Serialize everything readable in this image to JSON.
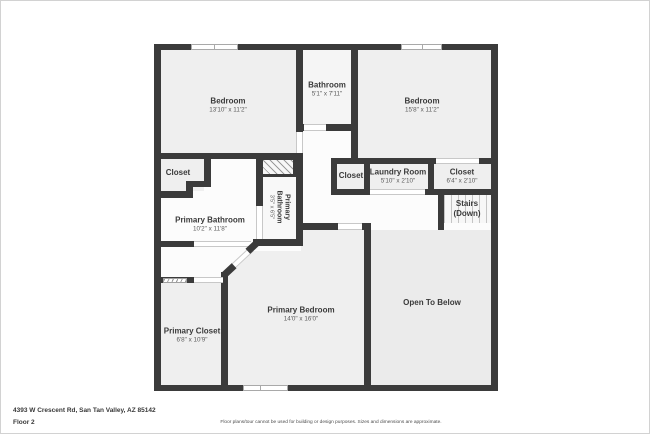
{
  "meta": {
    "address": "4393 W Crescent Rd, San Tan Valley, AZ 85142",
    "floor_label": "Floor 2",
    "disclaimer": "Floor plans/tour cannot be used for building or design purposes. Sizes and dimensions are approximate."
  },
  "plan": {
    "colors": {
      "wall": "#3b3b3b",
      "room_fill": "#efefef",
      "hall_fill": "#fcfcfc",
      "open_to_below_fill": "#ebebeb",
      "stairs_fill": "#f7f7f7",
      "door_line": "#c8c8c8",
      "window_border": "#a9a9a9"
    },
    "rooms": [
      {
        "id": "bedroom-1",
        "name": "Bedroom",
        "dims": "13'10\" x 11'2\""
      },
      {
        "id": "bathroom",
        "name": "Bathroom",
        "dims": "5'1\" x 7'11\""
      },
      {
        "id": "bedroom-2",
        "name": "Bedroom",
        "dims": "15'8\" x 11'2\""
      },
      {
        "id": "closet-left",
        "name": "Closet",
        "dims": ""
      },
      {
        "id": "closet-middle",
        "name": "Closet",
        "dims": ""
      },
      {
        "id": "laundry-room",
        "name": "Laundry Room",
        "dims": "5'10\" x 2'10\""
      },
      {
        "id": "closet-right",
        "name": "Closet",
        "dims": "6'4\" x 2'10\""
      },
      {
        "id": "stairs",
        "name": "Stairs",
        "dims": "(Down)"
      },
      {
        "id": "primary-bathroom",
        "name": "Primary Bathroom",
        "dims": "10'2\" x 11'8\""
      },
      {
        "id": "primary-bathroom-small",
        "name": "Primary Bathroom",
        "dims": "3'5\" x 6'5\""
      },
      {
        "id": "primary-bedroom",
        "name": "Primary Bedroom",
        "dims": "14'0\" x 16'0\""
      },
      {
        "id": "primary-closet",
        "name": "Primary Closet",
        "dims": "6'8\" x 10'9\""
      },
      {
        "id": "open-to-below",
        "name": "Open To Below",
        "dims": ""
      }
    ]
  }
}
